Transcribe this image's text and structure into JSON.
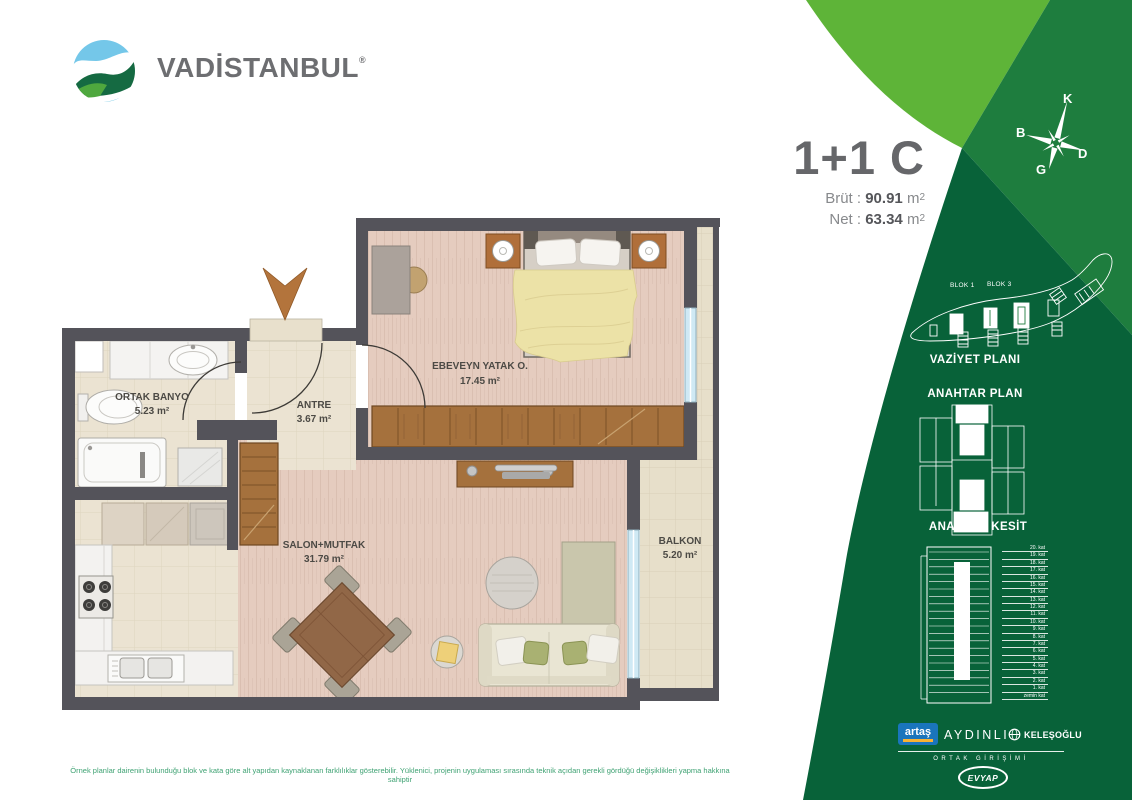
{
  "brand": {
    "name": "VADİSTANBUL",
    "registered": "®"
  },
  "unit": {
    "title": "1+1 C",
    "brut_label": "Brüt :",
    "brut_value": "90.91",
    "net_label": "Net :",
    "net_value": "63.34",
    "area_unit_base": "m",
    "area_unit_exp": "2"
  },
  "compass": {
    "north": "K",
    "west": "B",
    "east": "D",
    "south": "G"
  },
  "site_plan": {
    "title": "VAZİYET PLANI",
    "blok1": "BLOK 1",
    "blok3": "BLOK 3"
  },
  "key_plan": {
    "title": "ANAHTAR PLAN"
  },
  "key_section": {
    "title": "ANAHTAR KESİT",
    "floors": [
      "20. kat",
      "19. kat",
      "18. kat",
      "17. kat",
      "16. kat",
      "15. kat",
      "14. kat",
      "13. kat",
      "12. kat",
      "11. kat",
      "10. kat",
      "9. kat",
      "8. kat",
      "7. kat",
      "6. kat",
      "5. kat",
      "4. kat",
      "3. kat",
      "2. kat",
      "1. kat",
      "zemin kat"
    ]
  },
  "rooms": [
    {
      "name": "EBEVEYN YATAK O.",
      "area": "17.45 m²"
    },
    {
      "name": "ORTAK BANYO",
      "area": "5.23 m²"
    },
    {
      "name": "ANTRE",
      "area": "3.67 m²"
    },
    {
      "name": "SALON+MUTFAK",
      "area": "31.79 m²"
    },
    {
      "name": "BALKON",
      "area": "5.20 m²"
    }
  ],
  "partners": {
    "artas": "artaş",
    "aydinli": "AYDINLI",
    "kelesoglu": "KELEŞOĞLU",
    "joint_venture": "ORTAK GİRİŞİMİ",
    "evyap": "EVYAP"
  },
  "disclaimer": "Örnek planlar dairenin bulunduğu blok ve kata göre alt yapıdan kaynaklanan farklılıklar gösterebilir. Yüklenici, projenin uygulaması sırasında teknik açıdan gerekli gördüğü değişiklikleri yapma hakkına sahiptir",
  "colors": {
    "green_light": "#5eb438",
    "green_mid": "#1e7d3e",
    "green_dark": "#086239",
    "wall": "#54535a",
    "accent_blue": "#1a75bc",
    "accent_yellow": "#f9b233"
  }
}
